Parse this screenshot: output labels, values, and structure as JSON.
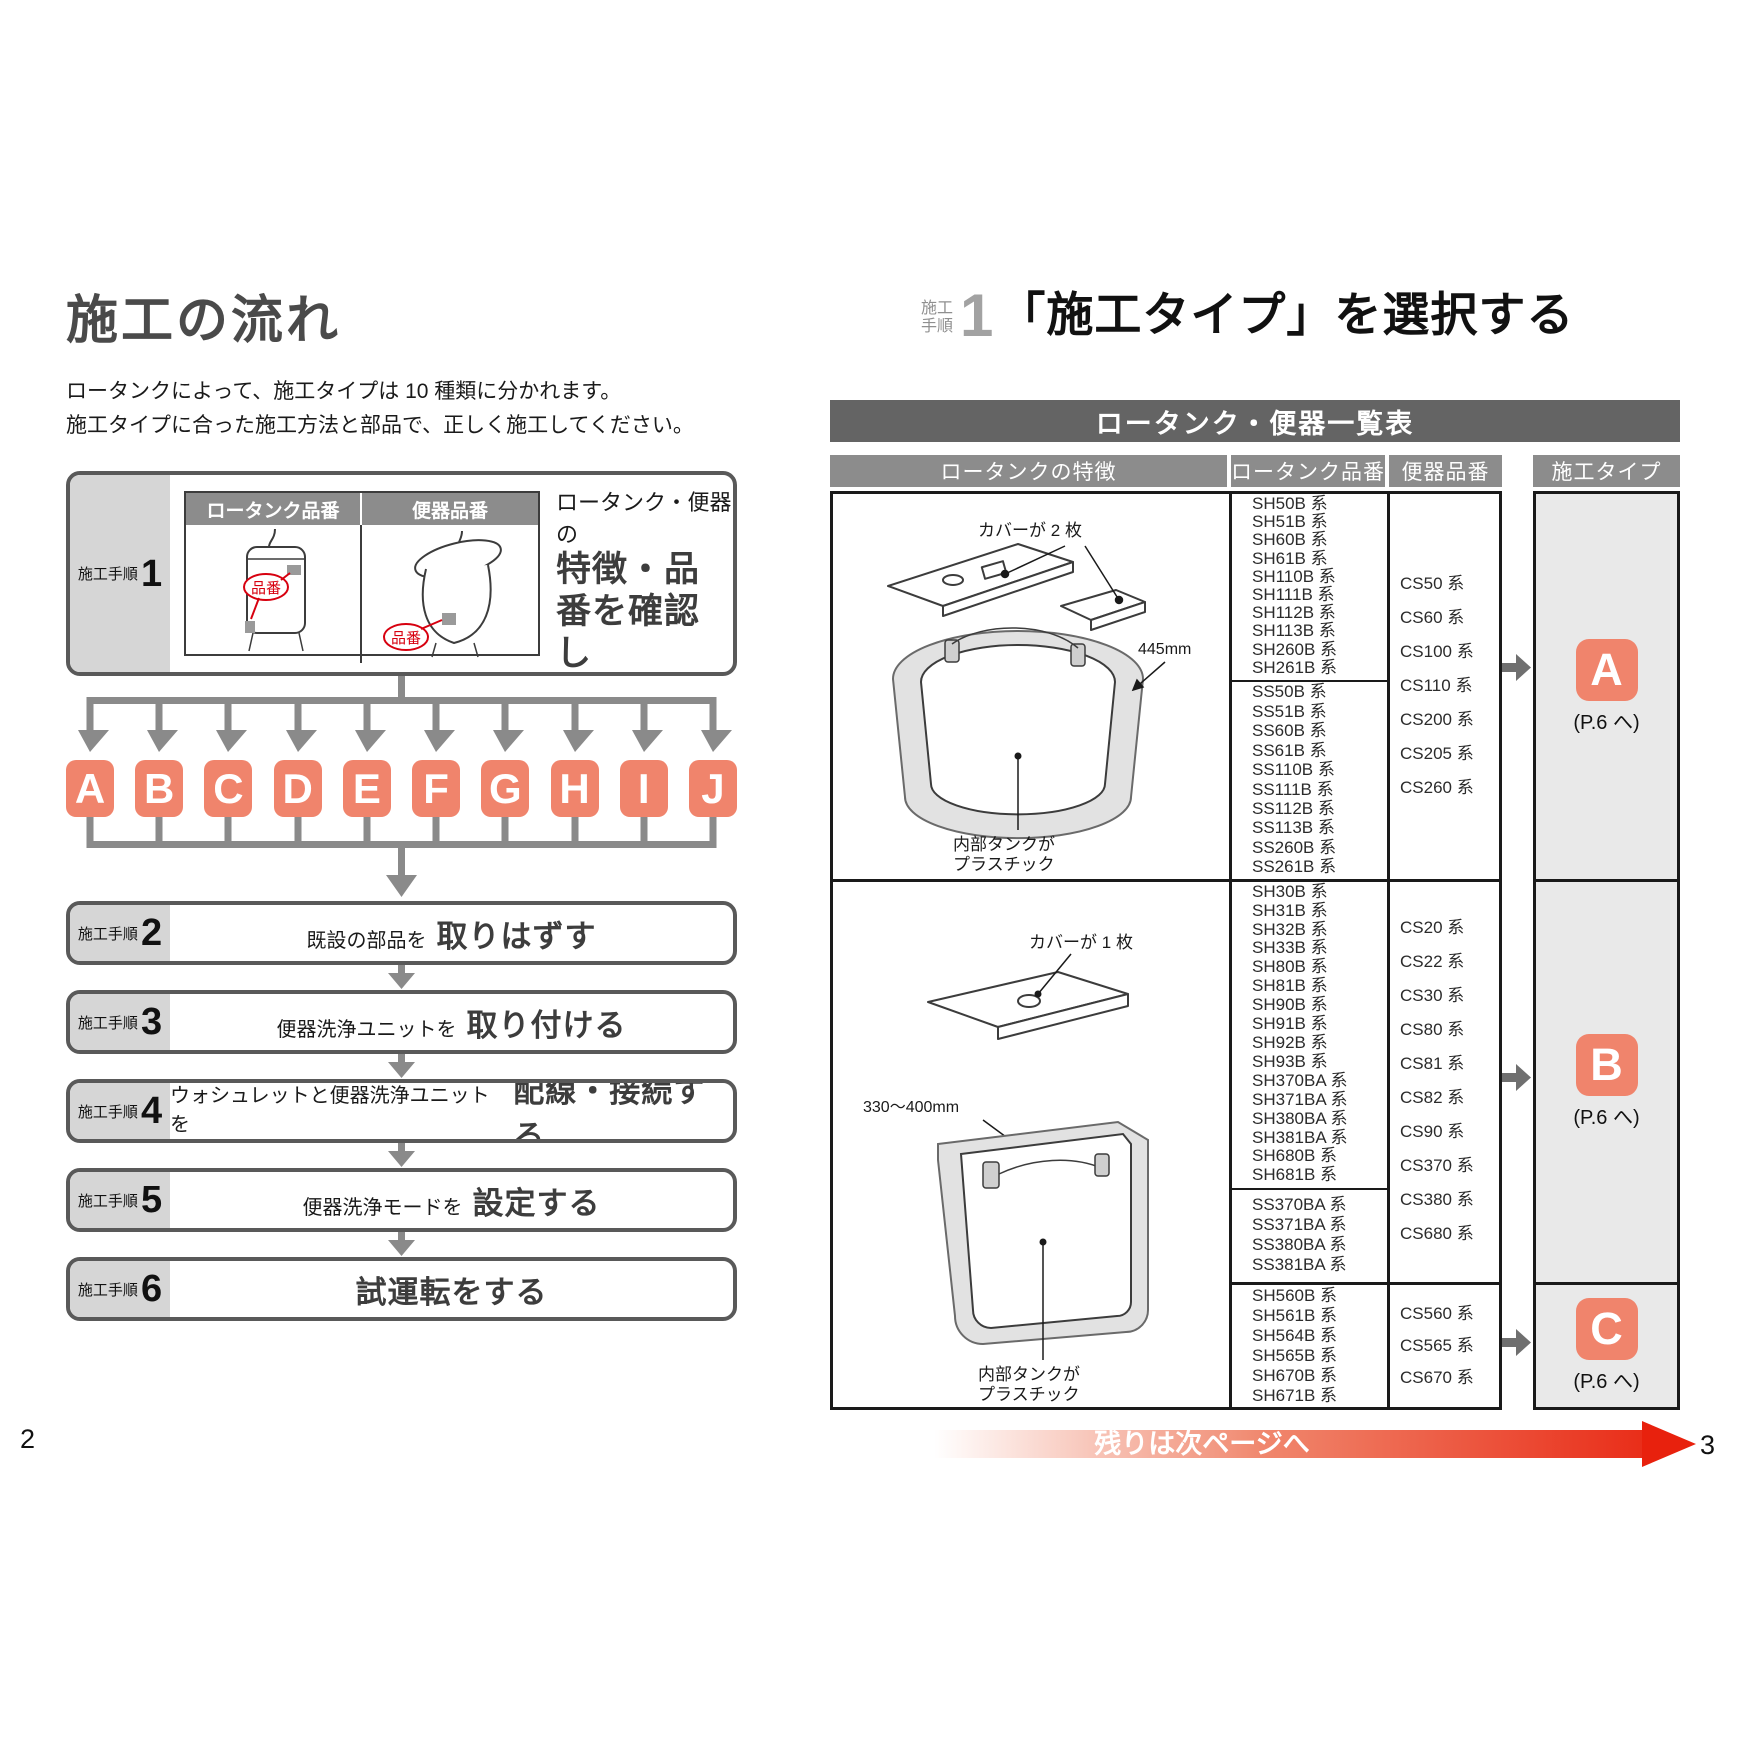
{
  "colors": {
    "accent_salmon": "#f0846c",
    "banner_gray": "#646464",
    "header_gray": "#8c8c8c",
    "label_gray": "#d6d6d6",
    "step_border": "#595959",
    "arrow_gray": "#8a8a8a",
    "red": "#e60012",
    "hinban_red": "#d7000f"
  },
  "left_page": {
    "page_number": "2",
    "title": "施工の流れ",
    "intro": [
      "ロータンクによって、施工タイプは 10 種類に分かれます。",
      "施工タイプに合った施工方法と部品で、正しく施工してください。"
    ],
    "step1": {
      "label": "施工手順",
      "number": "1",
      "image_table": {
        "headers": [
          "ロータンク品番",
          "便器品番"
        ],
        "tag": "品番"
      },
      "lead": "ロータンク・便器の",
      "bold_lines": [
        "特徴・品番を確認し",
        "「施工タイプ」",
        "を選択する"
      ]
    },
    "type_letters": [
      "A",
      "B",
      "C",
      "D",
      "E",
      "F",
      "G",
      "H",
      "I",
      "J"
    ],
    "steps": [
      {
        "label": "施工手順",
        "number": "2",
        "pre": "既設の部品を",
        "action": "取りはずす"
      },
      {
        "label": "施工手順",
        "number": "3",
        "pre": "便器洗浄ユニットを",
        "action": "取り付ける"
      },
      {
        "label": "施工手順",
        "number": "4",
        "pre": "ウォシュレットと便器洗浄ユニットを",
        "action": "配線・接続する"
      },
      {
        "label": "施工手順",
        "number": "5",
        "pre": "便器洗浄モードを",
        "action": "設定する"
      },
      {
        "label": "施工手順",
        "number": "6",
        "pre": "",
        "action": "試運転をする"
      }
    ]
  },
  "right_page": {
    "page_number": "3",
    "heading": {
      "label_top": "施工",
      "label_bottom": "手順",
      "number": "1",
      "title": "「施工タイプ」を選択する"
    },
    "banner_title": "ロータンク・便器一覧表",
    "table_headers": {
      "feature": "ロータンクの特徴",
      "tank": "ロータンク品番",
      "toilet": "便器品番",
      "type": "施工タイプ"
    },
    "tank_a_labels": {
      "cover": "カバーが 2 枚",
      "dim": "445mm",
      "inner1": "内部タンクが",
      "inner2": "プラスチック"
    },
    "tank_bc_labels": {
      "cover": "カバーが 1 枚",
      "dim": "330～400mm",
      "inner1": "内部タンクが",
      "inner2": "プラスチック"
    },
    "rows": [
      {
        "tank_models_top": [
          "SH50B 系",
          "SH51B 系",
          "SH60B 系",
          "SH61B 系",
          "SH110B 系",
          "SH111B 系",
          "SH112B 系",
          "SH113B 系",
          "SH260B 系",
          "SH261B 系"
        ],
        "tank_models_bottom": [
          "SS50B 系",
          "SS51B 系",
          "SS60B 系",
          "SS61B 系",
          "SS110B 系",
          "SS111B 系",
          "SS112B 系",
          "SS113B 系",
          "SS260B 系",
          "SS261B 系"
        ],
        "toilet_models": [
          "CS50 系",
          "CS60 系",
          "CS100 系",
          "CS110 系",
          "CS200 系",
          "CS205 系",
          "CS260 系"
        ],
        "type": "A",
        "type_note": "(P.6 へ)"
      },
      {
        "tank_models_top": [
          "SH30B 系",
          "SH31B 系",
          "SH32B 系",
          "SH33B 系",
          "SH80B 系",
          "SH81B 系",
          "SH90B 系",
          "SH91B 系",
          "SH92B 系",
          "SH93B 系",
          "SH370BA 系",
          "SH371BA 系",
          "SH380BA 系",
          "SH381BA 系",
          "SH680B 系",
          "SH681B 系"
        ],
        "tank_models_bottom": [
          "SS370BA 系",
          "SS371BA 系",
          "SS380BA 系",
          "SS381BA 系"
        ],
        "toilet_models": [
          "CS20 系",
          "CS22 系",
          "CS30 系",
          "CS80 系",
          "CS81 系",
          "CS82 系",
          "CS90 系",
          "CS370 系",
          "CS380 系",
          "CS680 系"
        ],
        "type": "B",
        "type_note": "(P.6 へ)"
      },
      {
        "tank_models_top": [
          "SH560B 系",
          "SH561B 系",
          "SH564B 系",
          "SH565B 系",
          "SH670B 系",
          "SH671B 系"
        ],
        "tank_models_bottom": [],
        "toilet_models": [
          "CS560 系",
          "CS565 系",
          "CS670 系"
        ],
        "type": "C",
        "type_note": "(P.6 へ)"
      }
    ],
    "footer_arrow_text": "残りは次ページへ"
  }
}
